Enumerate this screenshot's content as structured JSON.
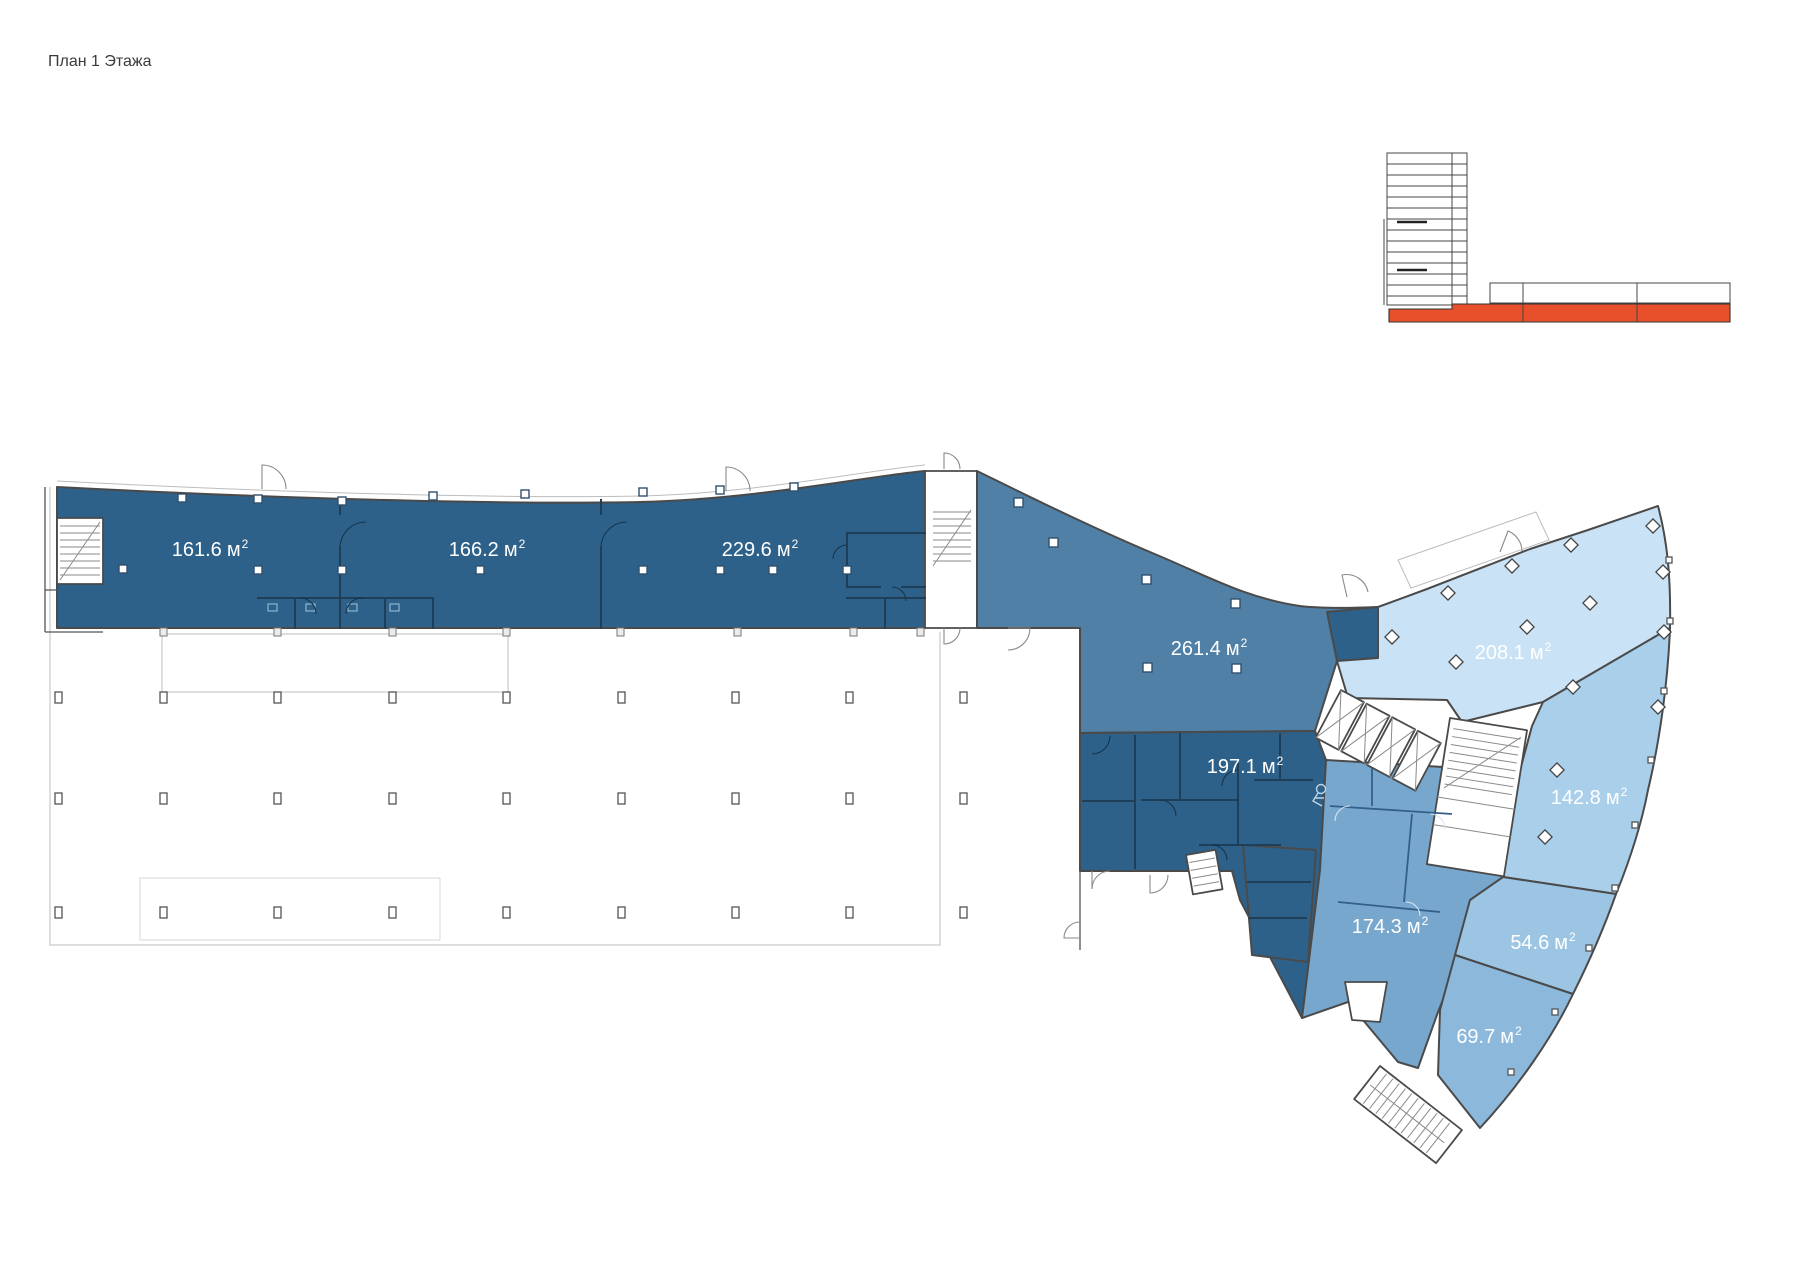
{
  "title": "План 1 Этажа",
  "colors": {
    "red": "#e8502b",
    "dark": "#2e6189",
    "mid": "#5080a6",
    "mid2": "#78a7cd",
    "l697": "#8cb8db",
    "l546": "#9cc5e4",
    "l1428": "#a9cfea",
    "l2081": "#c9e2f5"
  },
  "rooms": [
    {
      "name": "room-161-6",
      "area": "161.6",
      "unit": "м",
      "sup": "2",
      "color": "#2e6189"
    },
    {
      "name": "room-166-2",
      "area": "166.2",
      "unit": "м",
      "sup": "2",
      "color": "#2e6189"
    },
    {
      "name": "room-229-6",
      "area": "229.6",
      "unit": "м",
      "sup": "2",
      "color": "#2e6189"
    },
    {
      "name": "room-261-4",
      "area": "261.4",
      "unit": "м",
      "sup": "2",
      "color": "#5080a6"
    },
    {
      "name": "room-197-1",
      "area": "197.1",
      "unit": "м",
      "sup": "2",
      "color": "#2e6189"
    },
    {
      "name": "room-208-1",
      "area": "208.1",
      "unit": "м",
      "sup": "2",
      "color": "#c9e2f5"
    },
    {
      "name": "room-142-8",
      "area": "142.8",
      "unit": "м",
      "sup": "2",
      "color": "#a9cfea"
    },
    {
      "name": "room-174-3",
      "area": "174.3",
      "unit": "м",
      "sup": "2",
      "color": "#78a7cd"
    },
    {
      "name": "room-54-6",
      "area": "54.6",
      "unit": "м",
      "sup": "2",
      "color": "#9cc5e4"
    },
    {
      "name": "room-69-7",
      "area": "69.7",
      "unit": "м",
      "sup": "2",
      "color": "#8cb8db"
    }
  ]
}
